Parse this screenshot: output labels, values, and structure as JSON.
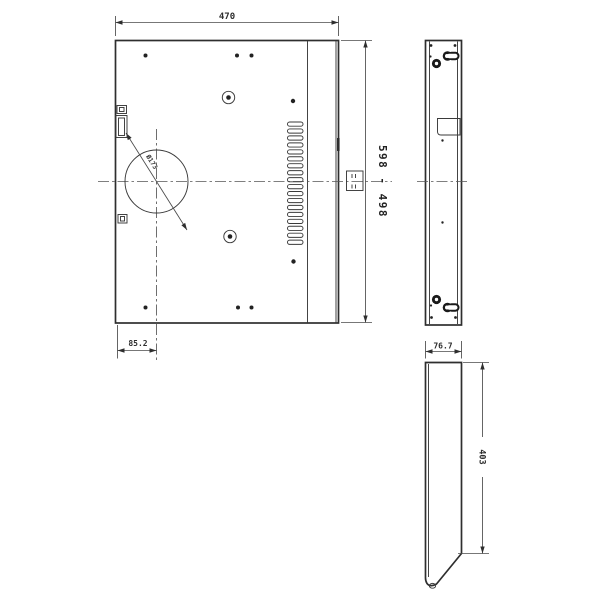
{
  "drawing": {
    "kind": "technical-drawing",
    "colors": {
      "background": "#ffffff",
      "line": "#2e2e2e"
    },
    "front_view": {
      "width_dim": "470",
      "height_dim": "598 - 498",
      "hole_diameter": "Ø173",
      "offset_dim": "85.2",
      "vent_slot_count": 18
    },
    "profile_view": {
      "width_dim": "76.7",
      "height_dim": "403"
    }
  }
}
